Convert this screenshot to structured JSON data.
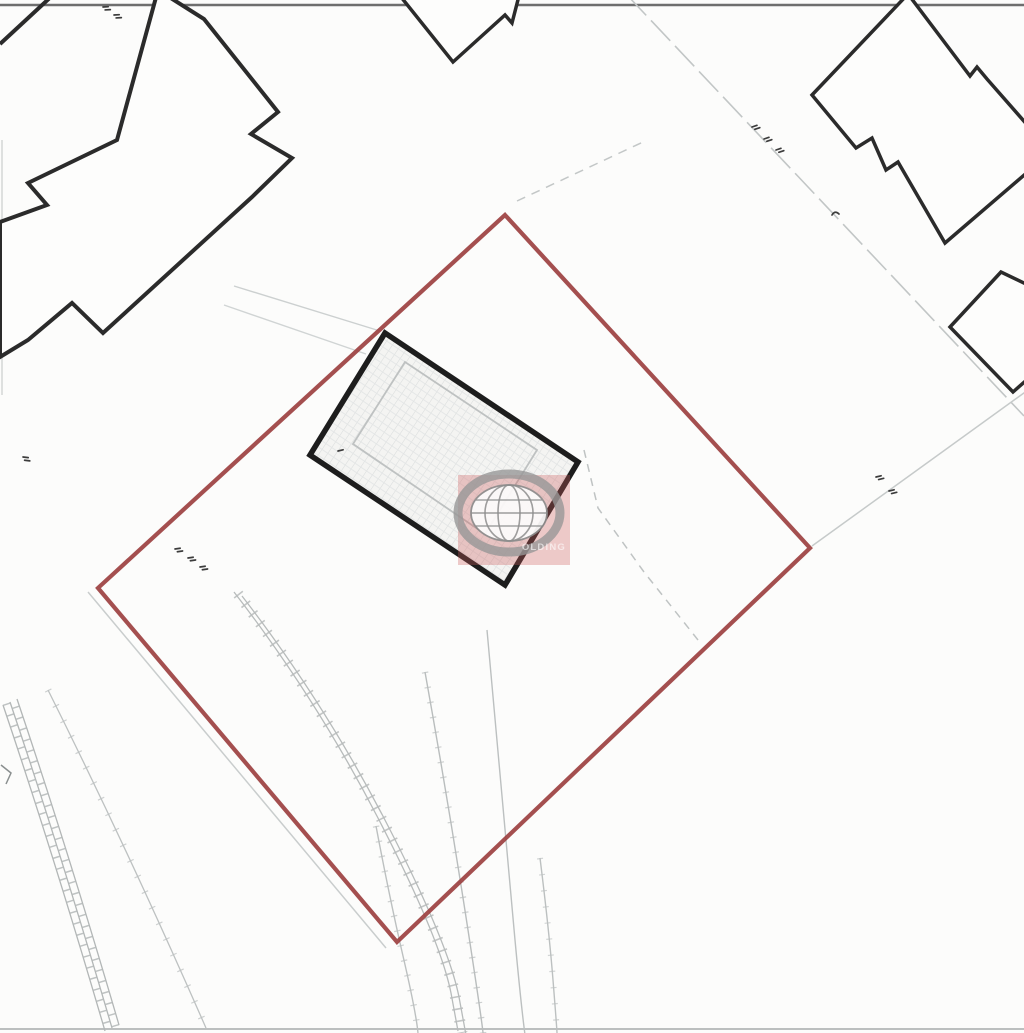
{
  "document": {
    "kind": "scanned site location plan",
    "canvas": {
      "width": 1024,
      "height": 1033
    }
  },
  "palette": {
    "paper": "#fcfcfb",
    "building_ink": "#2b2b2b",
    "subject_building_ink": "#1d1d1d",
    "boundary_red": "#9c4040",
    "faint_gray": "#bfc3c3",
    "watermark_red": "#cd5c5c"
  },
  "watermark": {
    "label": "globe-logo-watermark",
    "text": "OLDING"
  },
  "map": {
    "shapes": [
      {
        "name": "scan-border-top",
        "tag": "line",
        "attrs": {
          "x1": "0",
          "y1": "5",
          "x2": "1024",
          "y2": "5",
          "stroke": "#565656",
          "stroke-width": "2.5",
          "opacity": "0.85"
        }
      },
      {
        "name": "scan-border-bottom",
        "tag": "line",
        "attrs": {
          "x1": "0",
          "y1": "1029",
          "x2": "1024",
          "y2": "1029",
          "stroke": "#9aa0a0",
          "stroke-width": "2",
          "opacity": "0.65"
        }
      },
      {
        "name": "scan-edge-left",
        "tag": "line",
        "attrs": {
          "x1": "2",
          "y1": "140",
          "x2": "2",
          "y2": "395",
          "stroke": "#d3d6d6",
          "stroke-width": "1.5"
        }
      },
      {
        "name": "parcel-line-northeast",
        "tag": "line",
        "attrs": {
          "x1": "627",
          "y1": "-5",
          "x2": "1024",
          "y2": "416",
          "stroke": "#c2c6c6",
          "stroke-width": "1.6",
          "stroke-dasharray": "28 7"
        }
      },
      {
        "name": "parcel-line-east",
        "tag": "line",
        "attrs": {
          "x1": "812",
          "y1": "546",
          "x2": "1028",
          "y2": "390",
          "stroke": "#c6caca",
          "stroke-width": "1.5"
        }
      },
      {
        "name": "parcel-line-north-dashed",
        "tag": "line",
        "attrs": {
          "x1": "517",
          "y1": "201",
          "x2": "643",
          "y2": "142",
          "stroke": "#c3c7c7",
          "stroke-width": "1.5",
          "stroke-dasharray": "9 7"
        }
      },
      {
        "name": "boundary-companion-southwest",
        "tag": "line",
        "attrs": {
          "x1": "88",
          "y1": "592",
          "x2": "386",
          "y2": "948",
          "stroke": "#c9cdcd",
          "stroke-width": "1.5"
        }
      },
      {
        "name": "driveway-line-1",
        "tag": "line",
        "attrs": {
          "x1": "234",
          "y1": "286",
          "x2": "380",
          "y2": "331",
          "stroke": "#ccd0d0",
          "stroke-width": "1.4"
        }
      },
      {
        "name": "driveway-line-2",
        "tag": "line",
        "attrs": {
          "x1": "224",
          "y1": "305",
          "x2": "366",
          "y2": "354",
          "stroke": "#d0d4d4",
          "stroke-width": "1.4"
        }
      },
      {
        "name": "track-band-rail-left",
        "tag": "path",
        "attrs": {
          "d": "M10,702 Q60,850 112,1028",
          "transform": "translate(-7,3)",
          "fill": "none",
          "stroke": "#b2b6b6",
          "stroke-width": "1.3"
        }
      },
      {
        "name": "track-band-rail-mid",
        "tag": "path",
        "attrs": {
          "d": "M10,702 Q60,850 112,1028",
          "fill": "none",
          "stroke": "#b2b6b6",
          "stroke-width": "1.3"
        }
      },
      {
        "name": "track-band-rail-right",
        "tag": "path",
        "attrs": {
          "d": "M10,702 Q60,850 112,1028",
          "transform": "translate(7,-3)",
          "fill": "none",
          "stroke": "#b2b6b6",
          "stroke-width": "1.3"
        }
      },
      {
        "name": "track-band-rungs-1",
        "tag": "path",
        "attrs": {
          "d": "M10,702 Q60,850 112,1028",
          "transform": "translate(-3.5,1.5)",
          "fill": "none",
          "stroke": "#b4b8b8",
          "stroke-width": "8",
          "stroke-dasharray": "1.5 10",
          "opacity": "0.85"
        }
      },
      {
        "name": "track-band-rungs-2",
        "tag": "path",
        "attrs": {
          "d": "M10,702 Q60,850 112,1028",
          "transform": "translate(3.5,-1.5)",
          "fill": "none",
          "stroke": "#b4b8b8",
          "stroke-width": "8",
          "stroke-dasharray": "1.5 10",
          "stroke-dashoffset": "5",
          "opacity": "0.85"
        }
      },
      {
        "name": "track-outer-line",
        "tag": "path",
        "attrs": {
          "d": "M48,690 Q128,850 206,1028",
          "fill": "none",
          "stroke": "#bdc1c1",
          "stroke-width": "1.3"
        }
      },
      {
        "name": "track-outer-ticks",
        "tag": "path",
        "attrs": {
          "d": "M48,690 Q128,850 206,1028",
          "fill": "none",
          "stroke": "#bdc1c1",
          "stroke-width": "7",
          "stroke-dasharray": "1.2 16",
          "opacity": "0.75"
        }
      },
      {
        "name": "wall-corner-mark",
        "tag": "polyline",
        "attrs": {
          "points": "1,765 11,773 6,784",
          "fill": "none",
          "stroke": "#8a8f8f",
          "stroke-width": "1.5"
        }
      },
      {
        "name": "garden-steps-rail-left",
        "tag": "path",
        "attrs": {
          "d": "M238,594 Q320,700 382,820 T455,995 L462,1033",
          "transform": "translate(-4,-2)",
          "fill": "none",
          "stroke": "#b7bbbb",
          "stroke-width": "1.3"
        }
      },
      {
        "name": "garden-steps-rail-right",
        "tag": "path",
        "attrs": {
          "d": "M238,594 Q320,700 382,820 T455,995 L462,1033",
          "transform": "translate(4,2)",
          "fill": "none",
          "stroke": "#b7bbbb",
          "stroke-width": "1.3"
        }
      },
      {
        "name": "garden-steps-rungs",
        "tag": "path",
        "attrs": {
          "d": "M238,594 Q320,700 382,820 T455,995 L462,1033",
          "fill": "none",
          "stroke": "#b7bbbb",
          "stroke-width": "11",
          "stroke-dasharray": "1.6 10.5",
          "opacity": "0.85"
        }
      },
      {
        "name": "bank-curve-a",
        "tag": "path",
        "attrs": {
          "d": "M425,672 Q448,800 468,930 T482,1033",
          "fill": "none",
          "stroke": "#b9bdbd",
          "stroke-width": "1.4"
        }
      },
      {
        "name": "bank-curve-a-ticks",
        "tag": "path",
        "attrs": {
          "d": "M425,672 Q448,800 468,930 T482,1033",
          "fill": "none",
          "stroke": "#b9bdbd",
          "stroke-width": "6.5",
          "stroke-dasharray": "1.2 14",
          "opacity": "0.7"
        }
      },
      {
        "name": "bank-curve-b",
        "tag": "path",
        "attrs": {
          "d": "M487,630 Q500,780 515,940 T530,1033",
          "fill": "none",
          "stroke": "#bcc0c0",
          "stroke-width": "1.4"
        }
      },
      {
        "name": "bank-curve-c",
        "tag": "path",
        "attrs": {
          "d": "M540,858 Q549,930 553,980 T557,1033",
          "fill": "none",
          "stroke": "#bcc0c0",
          "stroke-width": "1.4"
        }
      },
      {
        "name": "bank-curve-c-ticks",
        "tag": "path",
        "attrs": {
          "d": "M540,858 Q549,930 553,980 T557,1033",
          "fill": "none",
          "stroke": "#bcc0c0",
          "stroke-width": "6",
          "stroke-dasharray": "1.2 15",
          "opacity": "0.65"
        }
      },
      {
        "name": "bank-curve-d",
        "tag": "path",
        "attrs": {
          "d": "M376,826 Q390,900 403,956 T418,1033",
          "fill": "none",
          "stroke": "#bcc0c0",
          "stroke-width": "1.4"
        }
      },
      {
        "name": "bank-curve-d-ticks",
        "tag": "path",
        "attrs": {
          "d": "M376,826 Q390,900 403,956 T418,1033",
          "fill": "none",
          "stroke": "#bcc0c0",
          "stroke-width": "6.5",
          "stroke-dasharray": "1.2 14",
          "opacity": "0.7"
        }
      },
      {
        "name": "fence-line-dashed-east-of-house",
        "tag": "polyline",
        "attrs": {
          "points": "584,450 598,508 644,572 698,640",
          "fill": "none",
          "stroke": "#bfc3c3",
          "stroke-width": "1.5",
          "stroke-dasharray": "8 6.5"
        }
      },
      {
        "name": "neighbor-building-corner-segment",
        "tag": "line",
        "attrs": {
          "x1": "0",
          "y1": "44",
          "x2": "54",
          "y2": "-6",
          "stroke": "#2b2b2b",
          "stroke-width": "4"
        }
      },
      {
        "name": "neighbor-building-northwest",
        "tag": "polygon",
        "attrs": {
          "points": "158,-10 204,19 278,112 251,134 292,158 252,197 103,333 72,303 28,340 0,357 0,222 47,205 28,183 117,140",
          "fill": "#fdfdfc",
          "stroke": "#2b2b2b",
          "stroke-width": "4",
          "stroke-linejoin": "miter"
        }
      },
      {
        "name": "neighbor-building-north",
        "tag": "polygon",
        "attrs": {
          "points": "397,-8 453,62 505,15 512,23 520,-8",
          "fill": "#fdfdfc",
          "stroke": "#2b2b2b",
          "stroke-width": "3.5"
        }
      },
      {
        "name": "neighbor-building-northeast",
        "tag": "polygon",
        "attrs": {
          "points": "908,-6 970,76 977,67 987,79 1030,128 1030,170 945,243 898,162 886,170 872,138 856,148 812,95",
          "fill": "#fdfdfc",
          "stroke": "#2b2b2b",
          "stroke-width": "3.5",
          "stroke-linejoin": "miter"
        }
      },
      {
        "name": "neighbor-building-east",
        "tag": "polygon",
        "attrs": {
          "points": "1001,272 950,327 1013,392 1030,377 1030,286",
          "fill": "#fdfdfc",
          "stroke": "#2b2b2b",
          "stroke-width": "3.5"
        }
      },
      {
        "name": "site-boundary-red",
        "tag": "polygon",
        "attrs": {
          "points": "505,215 810,548 397,942 98,588",
          "fill": "none",
          "stroke": "#9c4040",
          "stroke-width": "4.2",
          "stroke-linejoin": "miter",
          "opacity": "0.92"
        }
      },
      {
        "name": "subject-building-base",
        "tag": "polygon",
        "attrs": {
          "points": "385,333 578,462 505,585 310,455",
          "fill": "#f4f4f2",
          "stroke": "none"
        }
      },
      {
        "name": "subject-building-hatch",
        "tag": "polygon",
        "attrs": {
          "points": "385,333 578,462 505,585 310,455",
          "fill": "url(#hatch)",
          "stroke": "#1d1d1d",
          "stroke-width": "5.5",
          "stroke-linejoin": "miter"
        }
      },
      {
        "name": "subject-building-roof-outline",
        "tag": "polygon",
        "attrs": {
          "points": "405,362 537,450 485,534 353,444",
          "fill": "none",
          "stroke": "#b9bcbc",
          "stroke-width": "1.8",
          "opacity": "0.9"
        }
      },
      {
        "name": "annotation-mark",
        "tag": "path",
        "attrs": {
          "d": "M0,0 L5,1.5 M1,3.5 L6,5",
          "transform": "translate(103,7) rotate(-20)",
          "stroke": "#3c3c3c",
          "stroke-width": "1.7",
          "fill": "none",
          "stroke-linecap": "round"
        }
      },
      {
        "name": "annotation-mark",
        "tag": "path",
        "attrs": {
          "d": "M0,0 L5,1.5 M1,3.5 L6,5",
          "transform": "translate(114,15) rotate(-20)",
          "stroke": "#3c3c3c",
          "stroke-width": "1.7",
          "fill": "none",
          "stroke-linecap": "round"
        }
      },
      {
        "name": "annotation-mark",
        "tag": "path",
        "attrs": {
          "d": "M0,0 L5,1.5 M1,3.5 L6,5",
          "transform": "translate(752,127) rotate(-35)",
          "stroke": "#3c3c3c",
          "stroke-width": "1.7",
          "fill": "none",
          "stroke-linecap": "round"
        }
      },
      {
        "name": "annotation-mark",
        "tag": "path",
        "attrs": {
          "d": "M0,0 L5,1.5 M1,3.5 L6,5",
          "transform": "translate(764,139) rotate(-35)",
          "stroke": "#3c3c3c",
          "stroke-width": "1.7",
          "fill": "none",
          "stroke-linecap": "round"
        }
      },
      {
        "name": "annotation-mark",
        "tag": "path",
        "attrs": {
          "d": "M0,0 L5,1.5 M1,3.5 L6,5",
          "transform": "translate(776,150) rotate(-35)",
          "stroke": "#3c3c3c",
          "stroke-width": "1.7",
          "fill": "none",
          "stroke-linecap": "round"
        }
      },
      {
        "name": "annotation-mark",
        "tag": "path",
        "attrs": {
          "d": "M0,4 Q3,-1 7,3",
          "transform": "translate(832,211)",
          "stroke": "#3c3c3c",
          "stroke-width": "1.7",
          "fill": "none",
          "stroke-linecap": "round"
        }
      },
      {
        "name": "annotation-mark",
        "tag": "path",
        "attrs": {
          "d": "M0,0 L5,1.5 M1,3.5 L6,5",
          "transform": "translate(876,477) rotate(-30)",
          "stroke": "#3c3c3c",
          "stroke-width": "1.7",
          "fill": "none",
          "stroke-linecap": "round"
        }
      },
      {
        "name": "annotation-mark",
        "tag": "path",
        "attrs": {
          "d": "M0,0 L5,1.5 M1,3.5 L6,5",
          "transform": "translate(889,491) rotate(-30)",
          "stroke": "#3c3c3c",
          "stroke-width": "1.7",
          "fill": "none",
          "stroke-linecap": "round"
        }
      },
      {
        "name": "annotation-mark",
        "tag": "path",
        "attrs": {
          "d": "M0,0 L5,1.5 M1,3.5 L6,5",
          "transform": "translate(175,549) rotate(-25)",
          "stroke": "#3c3c3c",
          "stroke-width": "1.7",
          "fill": "none",
          "stroke-linecap": "round"
        }
      },
      {
        "name": "annotation-mark",
        "tag": "path",
        "attrs": {
          "d": "M0,0 L5,1.5 M1,3.5 L6,5",
          "transform": "translate(188,558) rotate(-25)",
          "stroke": "#3c3c3c",
          "stroke-width": "1.7",
          "fill": "none",
          "stroke-linecap": "round"
        }
      },
      {
        "name": "annotation-mark",
        "tag": "path",
        "attrs": {
          "d": "M0,0 L5,1.5 M1,3.5 L6,5",
          "transform": "translate(200,567) rotate(-25)",
          "stroke": "#3c3c3c",
          "stroke-width": "1.7",
          "fill": "none",
          "stroke-linecap": "round"
        }
      },
      {
        "name": "annotation-mark",
        "tag": "path",
        "attrs": {
          "d": "M0,0 L5,1.5",
          "transform": "translate(338,451) rotate(-30)",
          "stroke": "#3c3c3c",
          "stroke-width": "1.7",
          "fill": "none",
          "stroke-linecap": "round"
        }
      },
      {
        "name": "annotation-mark",
        "tag": "path",
        "attrs": {
          "d": "M0,0 L5,1.5 M1,3.5 L6,5",
          "transform": "translate(23,457) rotate(-10)",
          "stroke": "#3c3c3c",
          "stroke-width": "1.7",
          "fill": "none",
          "stroke-linecap": "round"
        }
      },
      {
        "name": "watermark-box",
        "tag": "rect",
        "attrs": {
          "x": "458",
          "y": "475",
          "width": "112",
          "height": "90",
          "fill": "#cd5c5c",
          "opacity": "0.32"
        }
      },
      {
        "name": "globe-icon-outer-ring",
        "tag": "ellipse",
        "attrs": {
          "cx": "509",
          "cy": "513",
          "rx": "51",
          "ry": "39",
          "fill": "none",
          "stroke": "#979797",
          "stroke-width": "9",
          "opacity": "0.8"
        }
      },
      {
        "name": "globe-icon-disc",
        "tag": "ellipse",
        "attrs": {
          "cx": "509",
          "cy": "513",
          "rx": "38",
          "ry": "28",
          "fill": "#fdfdfd",
          "stroke": "#8d8d8d",
          "stroke-width": "1.8",
          "opacity": "0.92"
        }
      },
      {
        "name": "globe-icon-meridian-1",
        "tag": "ellipse",
        "attrs": {
          "cx": "509",
          "cy": "513",
          "rx": "24",
          "ry": "28",
          "fill": "none",
          "stroke": "#8d8d8d",
          "stroke-width": "1.6",
          "opacity": "0.85"
        }
      },
      {
        "name": "globe-icon-meridian-2",
        "tag": "ellipse",
        "attrs": {
          "cx": "509",
          "cy": "513",
          "rx": "11",
          "ry": "28",
          "fill": "none",
          "stroke": "#8d8d8d",
          "stroke-width": "1.6",
          "opacity": "0.85"
        }
      },
      {
        "name": "globe-icon-equator",
        "tag": "line",
        "attrs": {
          "x1": "471",
          "y1": "513",
          "x2": "547",
          "y2": "513",
          "stroke": "#8d8d8d",
          "stroke-width": "1.6",
          "opacity": "0.85"
        }
      },
      {
        "name": "globe-icon-parallel-north",
        "tag": "line",
        "attrs": {
          "x1": "476",
          "y1": "500",
          "x2": "542",
          "y2": "500",
          "stroke": "#8d8d8d",
          "stroke-width": "1.5",
          "opacity": "0.8"
        }
      },
      {
        "name": "globe-icon-parallel-south",
        "tag": "line",
        "attrs": {
          "x1": "476",
          "y1": "526",
          "x2": "542",
          "y2": "526",
          "stroke": "#8d8d8d",
          "stroke-width": "1.5",
          "opacity": "0.8"
        }
      },
      {
        "name": "watermark-text",
        "tag": "text",
        "text": "OLDING",
        "attrs": {
          "x": "566",
          "y": "550",
          "text-anchor": "end",
          "fill": "#ffffff",
          "opacity": "0.6",
          "font-size": "9.5",
          "font-weight": "bold",
          "letter-spacing": "1.2",
          "font-family": "Liberation Sans, sans-serif"
        }
      }
    ]
  }
}
